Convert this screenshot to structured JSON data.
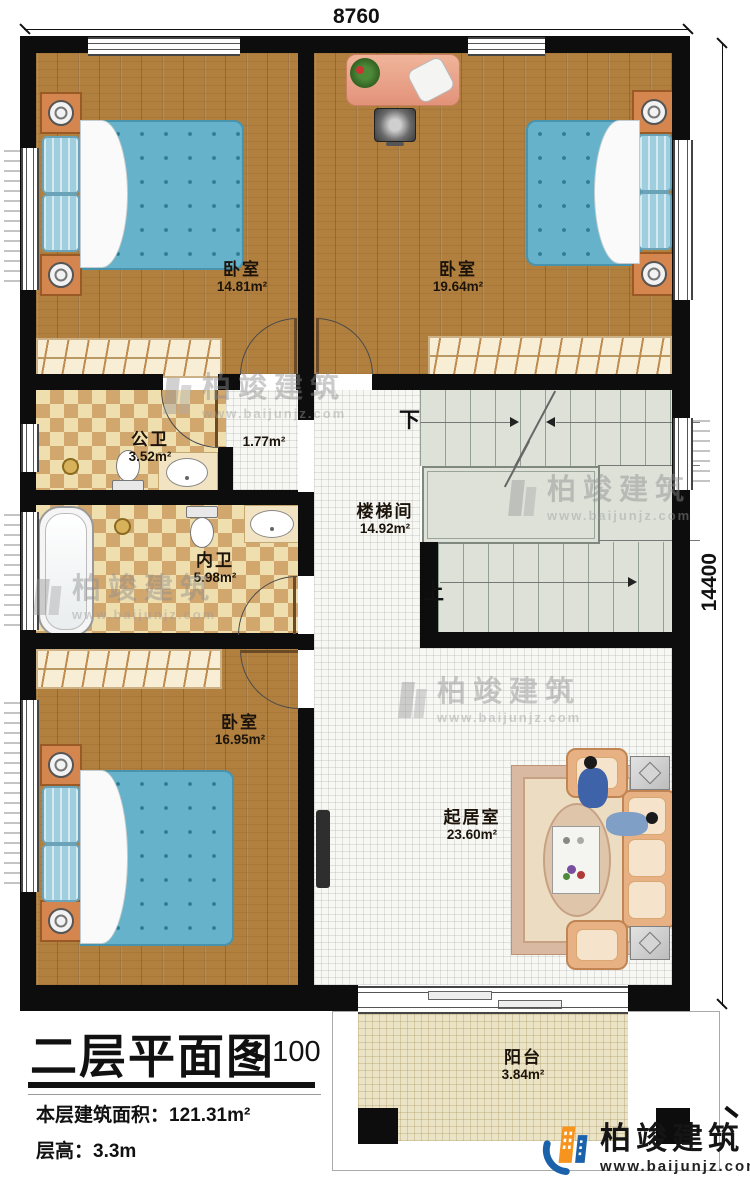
{
  "plan": {
    "dimensions": {
      "width_mm": "8760",
      "height_mm": "14400"
    },
    "rooms": {
      "bedroom_top_left": {
        "name": "卧室",
        "area": "14.81m²"
      },
      "bedroom_top_right": {
        "name": "卧室",
        "area": "19.64m²"
      },
      "public_bathroom": {
        "name": "公卫",
        "area": "3.52m²"
      },
      "hallway": {
        "area": "1.77m²"
      },
      "ensuite_bathroom": {
        "name": "内卫",
        "area": "5.98m²"
      },
      "stairwell": {
        "name": "楼梯间",
        "area": "14.92m²"
      },
      "bedroom_bottom_left": {
        "name": "卧室",
        "area": "16.95m²"
      },
      "living_room": {
        "name": "起居室",
        "area": "23.60m²"
      },
      "balcony": {
        "name": "阳台",
        "area": "3.84m²"
      }
    },
    "stairs": {
      "down": "下",
      "up": "上"
    }
  },
  "title_block": {
    "title": "二层平面图",
    "scale": "1:100",
    "floor_area_label": "本层建筑面积：",
    "floor_area_value": "121.31m²",
    "floor_height_label": "层高：",
    "floor_height_value": "3.3m"
  },
  "brand": {
    "name": "柏竣建筑",
    "website": "www.baijunjz.com"
  },
  "watermark": {
    "name": "柏竣建筑",
    "website": "www.baijunjz.com"
  },
  "colors": {
    "wall": "#0d0d0d",
    "wood_floor": "#b1803f",
    "bed_blue": "#66b2cb",
    "bath_tile_dark": "#d2a76e",
    "bath_tile_light": "#f0dfae",
    "brand_blue": "#1b62ab",
    "brand_orange": "#f7941d"
  }
}
